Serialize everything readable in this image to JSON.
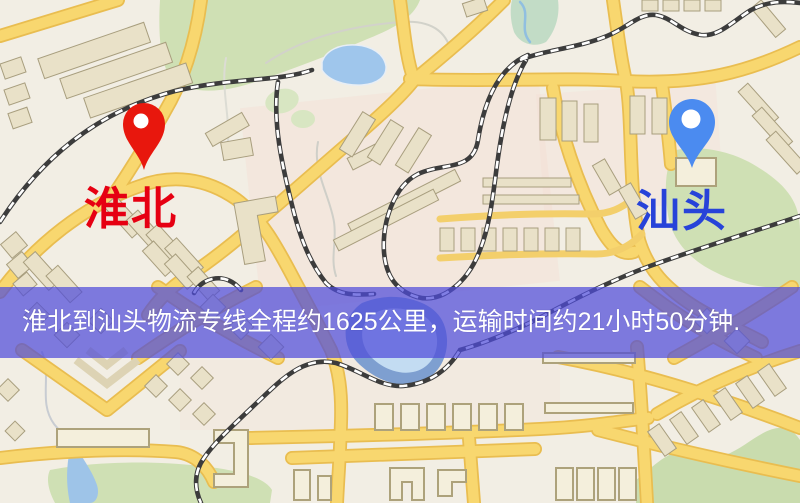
{
  "map": {
    "origin": {
      "label": "淮北",
      "pin_color": "#e8170d",
      "label_color": "#e60012"
    },
    "destination": {
      "label": "汕头",
      "pin_color": "#4b8bf0",
      "label_color": "#2743d9"
    },
    "theme": {
      "background": "#f2eee4",
      "road_fill": "#f8d76f",
      "road_casing": "#e9bd50",
      "building_fill": "#e9e1c8",
      "park_green": "#cfe0b4",
      "water_blue": "#9fc6ec",
      "railway_dark": "#3c3c3c"
    }
  },
  "banner": {
    "text": "淮北到汕头物流专线全程约1625公里，运输时间约21小时50分钟.",
    "bg_color": "rgba(79,76,217,0.72)",
    "text_color": "#ffffff",
    "distance": "约1625公里",
    "duration": "约21小时50分钟"
  }
}
